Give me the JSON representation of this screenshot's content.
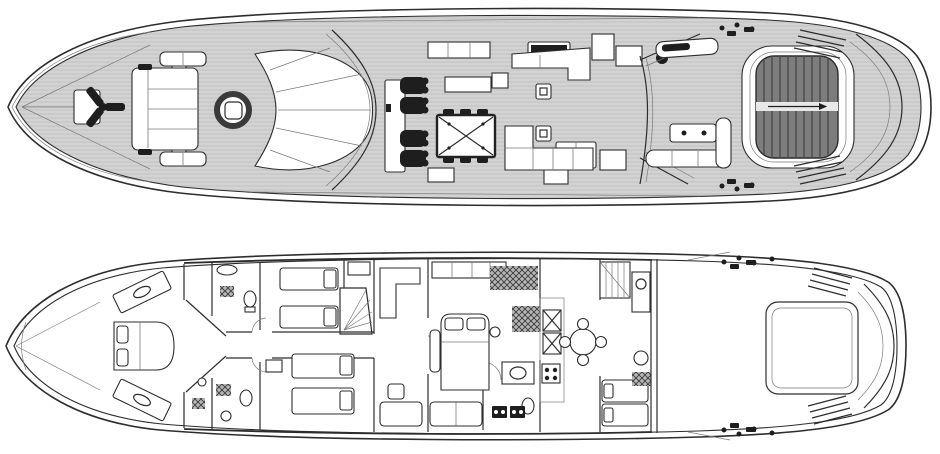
{
  "page": {
    "background": "#ffffff",
    "kind": "yacht deck plan line drawing"
  },
  "colors": {
    "line": "#2d2d2d",
    "line-soft": "#7a7a7a",
    "teak": "#d3d3d3",
    "teak-line": "#c0c0c0",
    "dark": "#1e1e1e",
    "slat": "#7d7d7d",
    "slat-line": "#4a4a4a",
    "hatch-fill": "#b5b5b5",
    "hatch-line": "#3c3c3c",
    "paper": "#ffffff"
  },
  "decks": [
    {
      "id": "main-deck",
      "label": "Main deck and flybridge plan",
      "features": [
        "bow pad",
        "anchor windlass",
        "foredeck bench",
        "foredeck sun pads",
        "round cocktail table",
        "curved lounge",
        "windshield",
        "helm console",
        "helm chairs",
        "dining table with cross base",
        "sideboards",
        "wet bar",
        "saloon sofa",
        "side tables",
        "galley units",
        "crane davit",
        "aft sun pad",
        "cockpit table",
        "cockpit bench",
        "stern sun lounger",
        "boarding steps",
        "transom",
        "mooring hardware"
      ]
    },
    {
      "id": "lower-deck",
      "label": "Lower deck accommodation plan",
      "features": [
        "forepeak",
        "VIP cabin bed",
        "angled wardrobes",
        "guest twin cabins",
        "guest bathrooms",
        "companionway stairs",
        "walk-in closet",
        "master cabin bed",
        "master ensuite",
        "galley fridge and stove",
        "crew mess table",
        "crew stairs",
        "crew bunks",
        "crew bathroom",
        "engine room",
        "tender garage hatch",
        "swim platform steps",
        "transom",
        "mooring hardware"
      ]
    }
  ]
}
